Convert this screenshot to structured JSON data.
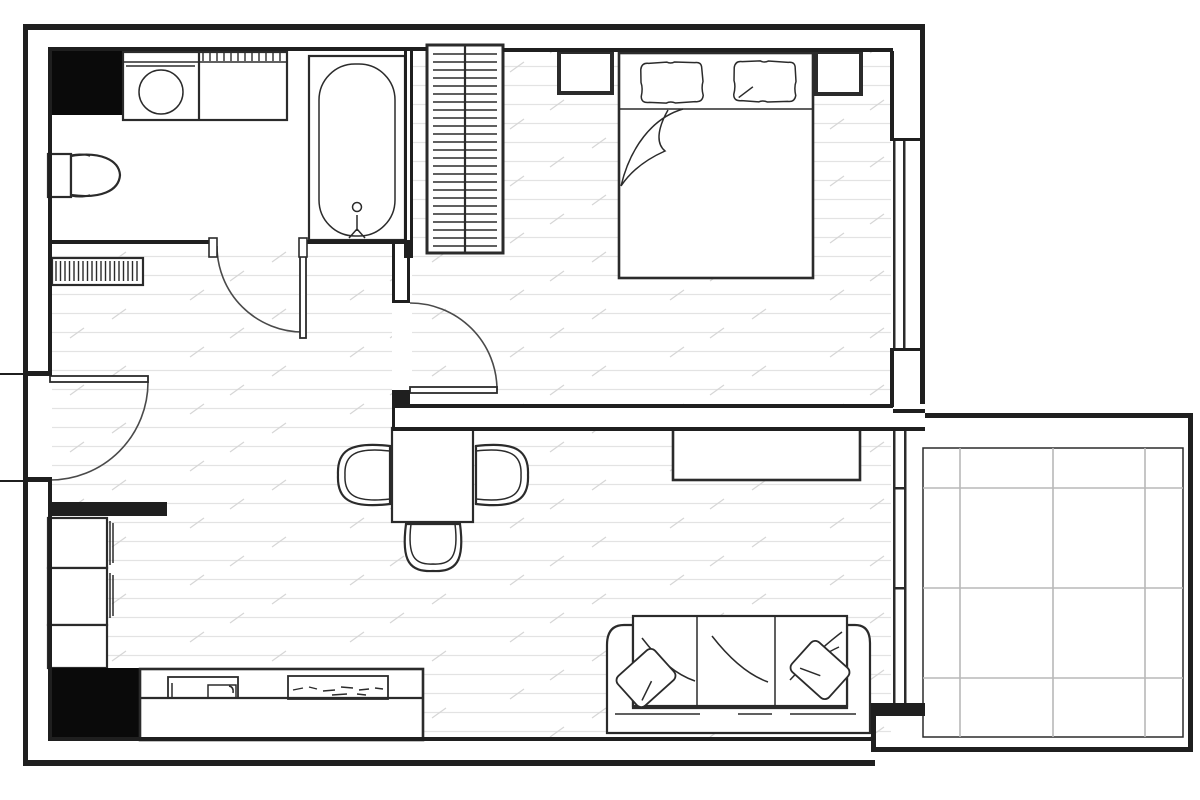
{
  "document": {
    "kind": "architectural floor plan",
    "visible_text": "",
    "style": "black line art on white, hatched wood floors, tiled balcony"
  },
  "colors": {
    "paper": "#ffffff",
    "wall": "#1f1f1f",
    "solid": "#0a0a0a",
    "line": "#2b2b2b",
    "arc": "#4a4a4a",
    "tile": "#b8b8b8",
    "floorline": "#e3e3e3",
    "floortick": "#d6d6d6"
  },
  "rooms": [
    {
      "id": "bathroom",
      "position": "top-left"
    },
    {
      "id": "hallway",
      "position": "center-left"
    },
    {
      "id": "bedroom",
      "position": "top-right"
    },
    {
      "id": "living-room",
      "position": "bottom-center"
    },
    {
      "id": "kitchen",
      "position": "bottom-left"
    },
    {
      "id": "balcony",
      "position": "right"
    }
  ],
  "fixtures": [
    "duct-shaft-black-block (bathroom)",
    "washing-machine-with-counter",
    "toilet",
    "bathtub-with-drain",
    "entry-doormat-grille",
    "wardrobe-with-hanging-rail",
    "double-bed-with-two-pillows-and-folded-blanket",
    "nightstand-left",
    "nightstand-right",
    "dining-table-with-three-chairs",
    "sideboard-console",
    "three-seat-sofa-with-two-cushions",
    "kitchen-tall-cabinets",
    "kitchen-black-counter-block",
    "kitchen-counter-with-sink-and-cooktop",
    "balcony-tile-grid"
  ],
  "openings": [
    "front-door-left-wall-swing-in",
    "bathroom-door-swing-to-hallway",
    "bedroom-door-swing-in",
    "bedroom-window-right-wall",
    "living-room-balcony-window"
  ]
}
